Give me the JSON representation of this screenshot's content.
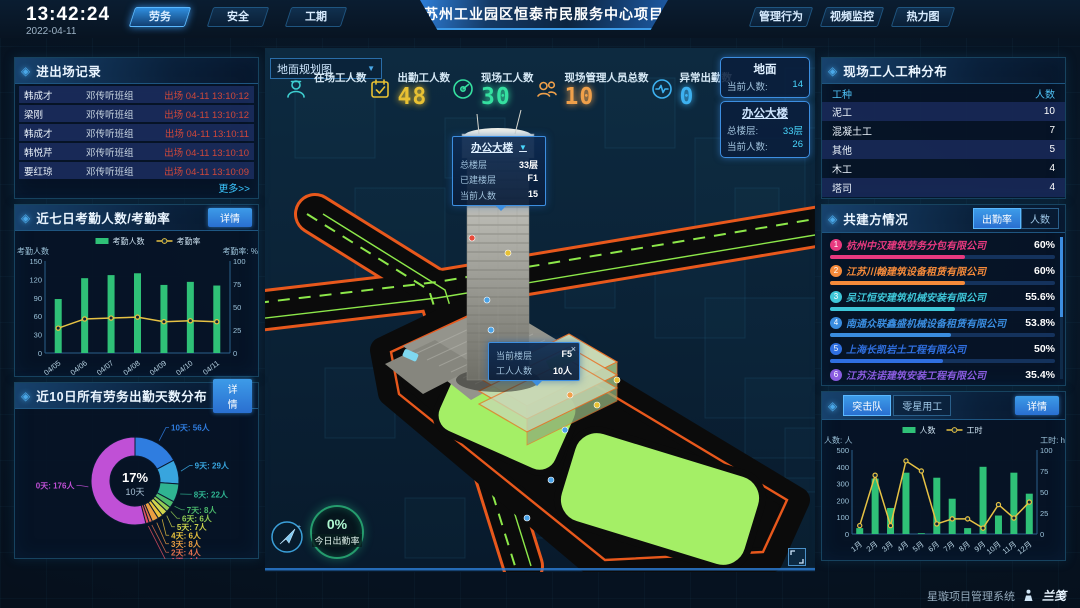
{
  "header": {
    "time": "13:42:24",
    "date": "2022-04-11",
    "left_tabs": [
      {
        "label": "劳务",
        "active": true
      },
      {
        "label": "安全",
        "active": false
      },
      {
        "label": "工期",
        "active": false
      }
    ],
    "title": "苏州工业园区恒泰市民服务中心项目",
    "right_tabs": [
      {
        "label": "管理行为",
        "active": false
      },
      {
        "label": "视频监控",
        "active": false
      },
      {
        "label": "热力图",
        "active": false
      }
    ]
  },
  "ui": {
    "detail_label": "详情"
  },
  "entry_exit": {
    "title": "进出场记录",
    "more_label": "更多>>",
    "rows": [
      {
        "name": "韩成才",
        "team": "邓传听班组",
        "event": "出场 04-11 13:10:12"
      },
      {
        "name": "梁刚",
        "team": "邓传听班组",
        "event": "出场 04-11 13:10:12"
      },
      {
        "name": "韩成才",
        "team": "邓传听班组",
        "event": "出场 04-11 13:10:11"
      },
      {
        "name": "韩悦芹",
        "team": "邓传听班组",
        "event": "出场 04-11 13:10:10"
      },
      {
        "name": "要红琼",
        "team": "邓传听班组",
        "event": "出场 04-11 13:10:09"
      }
    ]
  },
  "worker_types": {
    "title": "现场工人工种分布",
    "headers": {
      "type": "工种",
      "count": "人数"
    },
    "rows": [
      {
        "type": "泥工",
        "count": 10
      },
      {
        "type": "混凝土工",
        "count": 7
      },
      {
        "type": "其他",
        "count": 5
      },
      {
        "type": "木工",
        "count": 4
      },
      {
        "type": "塔司",
        "count": 4
      }
    ]
  },
  "partners": {
    "title": "共建方情况",
    "tabs": [
      {
        "label": "出勤率",
        "active": true
      },
      {
        "label": "人数",
        "active": false
      }
    ],
    "items": [
      {
        "rank": 1,
        "name": "杭州中汉建筑劳务分包有限公司",
        "pct": 60,
        "pct_label": "60%",
        "color": "#e8397f"
      },
      {
        "rank": 2,
        "name": "江苏川翰建筑设备租赁有限公司",
        "pct": 60,
        "pct_label": "60%",
        "color": "#f58a3a"
      },
      {
        "rank": 3,
        "name": "吴江恒安建筑机械安装有限公司",
        "pct": 55.6,
        "pct_label": "55.6%",
        "color": "#3ec6d8"
      },
      {
        "rank": 4,
        "name": "南通众联鑫盛机械设备租赁有限公司",
        "pct": 53.8,
        "pct_label": "53.8%",
        "color": "#3a8de0"
      },
      {
        "rank": 5,
        "name": "上海长凯岩土工程有限公司",
        "pct": 50,
        "pct_label": "50%",
        "color": "#2f6fe0"
      },
      {
        "rank": 6,
        "name": "江苏法诺建筑安装工程有限公司",
        "pct": 35.4,
        "pct_label": "35.4%",
        "color": "#8a5ce0"
      }
    ]
  },
  "squad": {
    "tabs": [
      {
        "label": "突击队",
        "active": true
      },
      {
        "label": "零星用工",
        "active": false
      }
    ]
  },
  "scene": {
    "dropdown": "地面规划图",
    "stats": [
      {
        "icon": "worker",
        "label": "在场工人数",
        "value": "",
        "color": "#3ecfd0"
      },
      {
        "icon": "calendar",
        "label": "出勤工人数",
        "value": "48",
        "color": "#e8c133"
      },
      {
        "icon": "gauge",
        "label": "现场工人数",
        "value": "30",
        "color": "#35e0a0"
      },
      {
        "icon": "people",
        "label": "现场管理人员总数",
        "value": "10",
        "color": "#f0a04a"
      },
      {
        "icon": "pulse",
        "label": "异常出勤数",
        "value": "0",
        "color": "#3db1f0"
      }
    ],
    "panels": [
      {
        "title": "地面",
        "link": false,
        "rows": [
          {
            "label": "当前人数:",
            "value": "14"
          }
        ]
      },
      {
        "title": "办公大楼",
        "link": true,
        "rows": [
          {
            "label": "总楼层:",
            "value": "33层"
          },
          {
            "label": "当前人数:",
            "value": "26"
          }
        ]
      }
    ],
    "tooltip_building": {
      "title": "办公大楼",
      "rows": [
        {
          "label": "总楼层",
          "value": "33层"
        },
        {
          "label": "已建楼层",
          "value": "F1"
        },
        {
          "label": "当前人数",
          "value": "15"
        }
      ]
    },
    "tooltip_floor": {
      "close": "×",
      "rows": [
        {
          "label": "当前楼层",
          "value": "F5"
        },
        {
          "label": "工人人数",
          "value": "10人"
        }
      ]
    },
    "gauge": {
      "value": "0%",
      "label": "今日出勤率"
    }
  },
  "footer": {
    "system": "星璇项目管理系统",
    "logo": "兰笺"
  },
  "chart_data": [
    {
      "id": "attendance7",
      "type": "bar",
      "title": "近七日考勤人数/考勤率",
      "categories": [
        "04/05",
        "04/06",
        "04/07",
        "04/08",
        "04/09",
        "04/10",
        "04/11"
      ],
      "series": [
        {
          "name": "考勤人数",
          "type": "bar",
          "axis": "left",
          "values": [
            88,
            122,
            127,
            130,
            111,
            116,
            110
          ]
        },
        {
          "name": "考勤率",
          "type": "line",
          "axis": "right",
          "values": [
            27,
            37,
            38,
            39,
            34,
            35,
            34
          ]
        }
      ],
      "y_left": {
        "label": "考勤人数",
        "min": 0,
        "max": 150,
        "ticks": [
          0,
          30,
          60,
          90,
          120,
          150
        ]
      },
      "y_right": {
        "label": "考勤率: %",
        "min": 0,
        "max": 100,
        "ticks": [
          0,
          25,
          50,
          75,
          100
        ]
      },
      "colors": {
        "bar": "#2fc177",
        "line": "#e6c244"
      },
      "legend_position": "top",
      "grid": false
    },
    {
      "id": "attendance-days",
      "type": "pie",
      "title": "近10日所有劳务出勤天数分布",
      "center_value": "17%",
      "center_label": "10天",
      "items": [
        {
          "label": "10天",
          "count": "56人",
          "value": 56,
          "color": "#2f7de0"
        },
        {
          "label": "9天",
          "count": "29人",
          "value": 29,
          "color": "#38a5de"
        },
        {
          "label": "8天",
          "count": "22人",
          "value": 22,
          "color": "#2fb492"
        },
        {
          "label": "7天",
          "count": "8人",
          "value": 8,
          "color": "#4cbb6d"
        },
        {
          "label": "6天",
          "count": "6人",
          "value": 6,
          "color": "#93cc53"
        },
        {
          "label": "5天",
          "count": "7人",
          "value": 7,
          "color": "#cfd44d"
        },
        {
          "label": "4天",
          "count": "6人",
          "value": 6,
          "color": "#e8c23d"
        },
        {
          "label": "3天",
          "count": "8人",
          "value": 8,
          "color": "#eb9f42"
        },
        {
          "label": "2天",
          "count": "4人",
          "value": 4,
          "color": "#e2704d"
        },
        {
          "label": "1天",
          "count": "4人",
          "value": 4,
          "color": "#e34f63"
        },
        {
          "label": "0天",
          "count": "176人",
          "value": 176,
          "color": "#c050d6"
        }
      ]
    },
    {
      "id": "squad-monthly",
      "type": "bar",
      "title": "突击队月度人数/工时",
      "categories": [
        "1月",
        "2月",
        "3月",
        "4月",
        "5月",
        "6月",
        "7月",
        "8月",
        "9月",
        "10月",
        "11月",
        "12月"
      ],
      "series": [
        {
          "name": "人数",
          "type": "bar",
          "axis": "left",
          "values": [
            35,
            330,
            155,
            365,
            5,
            335,
            210,
            35,
            400,
            110,
            365,
            240
          ]
        },
        {
          "name": "工时",
          "type": "line",
          "axis": "right",
          "values": [
            10,
            70,
            10,
            87,
            75,
            12,
            18,
            18,
            7,
            35,
            19,
            38
          ]
        }
      ],
      "y_left": {
        "label": "人数: 人",
        "min": 0,
        "max": 500,
        "ticks": [
          0,
          100,
          200,
          300,
          400,
          500
        ]
      },
      "y_right": {
        "label": "工时: h",
        "min": 0,
        "max": 100,
        "ticks": [
          0,
          25,
          50,
          75,
          100
        ]
      },
      "colors": {
        "bar": "#2fc177",
        "line": "#e6c244"
      },
      "legend_position": "top",
      "grid": false
    }
  ]
}
